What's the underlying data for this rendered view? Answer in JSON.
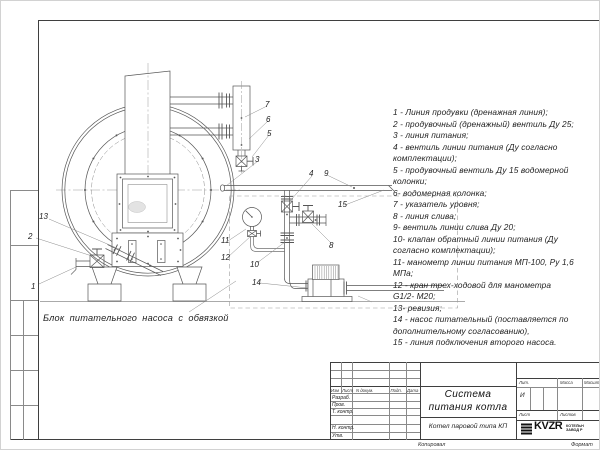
{
  "page": {
    "copied_label": "Копировал",
    "format_label": "Формат"
  },
  "legend": {
    "lines": [
      "1 - Линия продувки (дренажная линия);",
      "2 - продувочный (дренажный) вентиль Ду 25;",
      "3 - линия питания;",
      "4 - вентиль линии питания (Ду согласно",
      "комплектации);",
      "5 - продувочный вентиль Ду 15 водомерной",
      "колонки;",
      "6- водомерная колонка;",
      "7 - указатель уровня;",
      "8 - линия слива;",
      "9- вентиль линии слива Ду 20;",
      "10- клапан обратный линии питания (Ду",
      "согласно комплектации);",
      "11- манометр линии питания МП-100, Ру 1,6",
      "МПа;",
      "12 - кран трех-ходовой для манометра",
      "G1/2- М20;",
      "13- ревизия;",
      "14 - насос питательный (поставляется по",
      "дополнительному согласованию),",
      "15 - линия подключения второго насоса."
    ]
  },
  "drawing": {
    "caption": "Блок питательного насоса с обвязкой",
    "callouts": [
      {
        "n": "1",
        "x": 31,
        "y": 282
      },
      {
        "n": "2",
        "x": 28,
        "y": 232
      },
      {
        "n": "13",
        "x": 39,
        "y": 212
      },
      {
        "n": "3",
        "x": 255,
        "y": 155
      },
      {
        "n": "4",
        "x": 309,
        "y": 169
      },
      {
        "n": "5",
        "x": 267,
        "y": 129
      },
      {
        "n": "6",
        "x": 266,
        "y": 115
      },
      {
        "n": "7",
        "x": 265,
        "y": 100
      },
      {
        "n": "8",
        "x": 329,
        "y": 241
      },
      {
        "n": "9",
        "x": 324,
        "y": 169
      },
      {
        "n": "10",
        "x": 250,
        "y": 260
      },
      {
        "n": "11",
        "x": 221,
        "y": 236
      },
      {
        "n": "12",
        "x": 221,
        "y": 253
      },
      {
        "n": "14",
        "x": 252,
        "y": 278
      },
      {
        "n": "15",
        "x": 338,
        "y": 200
      }
    ]
  },
  "title_block": {
    "product_title_lines": [
      "Система",
      "питания котла"
    ],
    "product_subtitle": "Котел паровой типа КП",
    "change_header": {
      "izm": "Изм",
      "list": "Лист",
      "doc": "N докум.",
      "sign": "Подп.",
      "date": "Дата"
    },
    "signature_rows": [
      "Разраб.",
      "Пров.",
      "Т. контр.",
      "Н. контр.",
      "Утв."
    ],
    "lit_label": "Лит.",
    "lit_value": "И",
    "mass_label": "Масса",
    "scale_label": "Масштаб",
    "sheet_label": "Лист",
    "sheets_label": "Листов",
    "logo": {
      "text": "KVZR",
      "sub1": "КОТЕЛЬН",
      "sub2": "ЗАВОД Р"
    }
  }
}
